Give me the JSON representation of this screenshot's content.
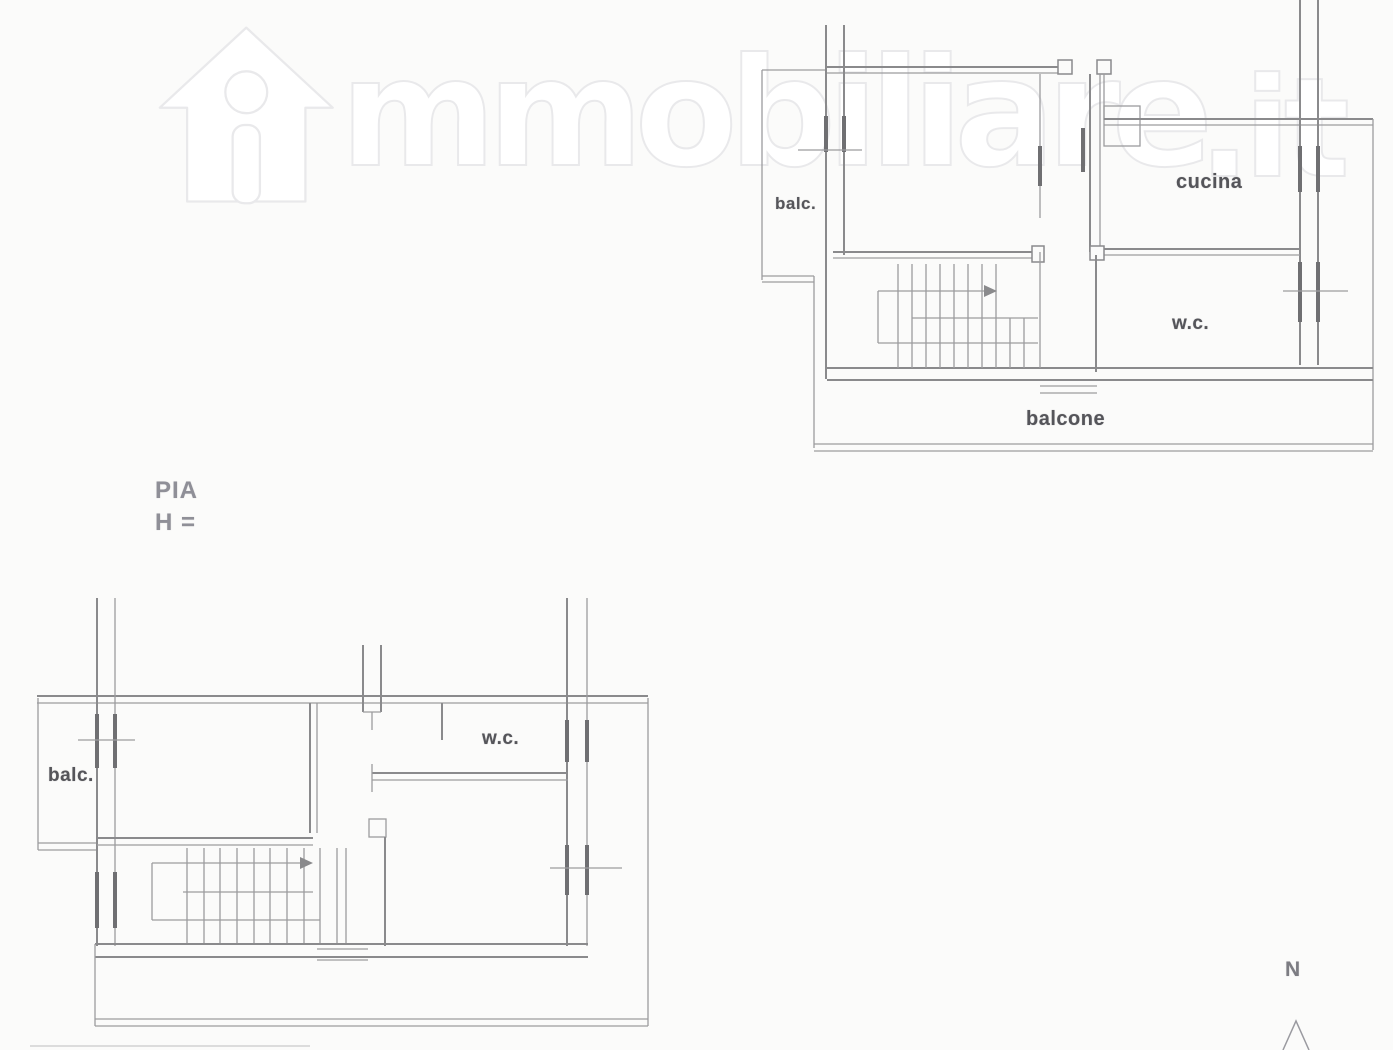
{
  "page": {
    "background": "#fbfbfa"
  },
  "watermark": {
    "icon": "house-logo-icon",
    "brand_rest": "mmobiliare",
    "brand_tld": ".it",
    "outline_color": "#e9e9eb"
  },
  "caption": {
    "line1": "PIA",
    "line2": "H ="
  },
  "upper_plan": {
    "labels": {
      "balcony_left": "balc.",
      "kitchen": "cucina",
      "wc": "w.c.",
      "balcony_bottom": "balcone"
    }
  },
  "lower_plan": {
    "labels": {
      "balcony_left": "balc.",
      "wc": "w.c."
    }
  },
  "compass": {
    "north_label": "N"
  },
  "colors": {
    "wall_line": "#8a8a8c",
    "thin_line": "#9c9c9e",
    "window_bar": "#6f6f72",
    "label_text": "#55555a",
    "caption_text": "#8f8f97",
    "watermark_outline": "#e9e9eb"
  }
}
